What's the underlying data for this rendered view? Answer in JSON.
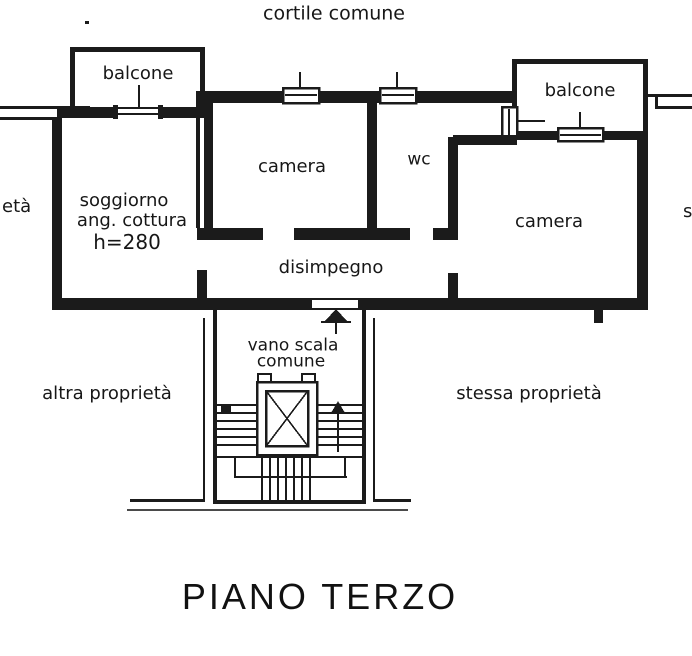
{
  "colors": {
    "ink": "#1b1b1b",
    "paper": "#ffffff"
  },
  "plan": {
    "title": "PIANO TERZO",
    "areas": {
      "courtyard": "cortile comune",
      "balcony_left": "balcone",
      "balcony_right": "balcone",
      "bedroom_top": "camera",
      "wc": "wc",
      "living": {
        "line1": "soggiorno",
        "line2": "ang. cottura",
        "line3": "h=280"
      },
      "bedroom_right": "camera",
      "hallway": "disimpegno",
      "stairwell": {
        "line1": "vano scala",
        "line2": "comune"
      },
      "other_property": "altra proprietà",
      "same_property": "stessa proprietà",
      "left_edge_cut_text": "età",
      "right_edge_cut_text": "s"
    }
  }
}
